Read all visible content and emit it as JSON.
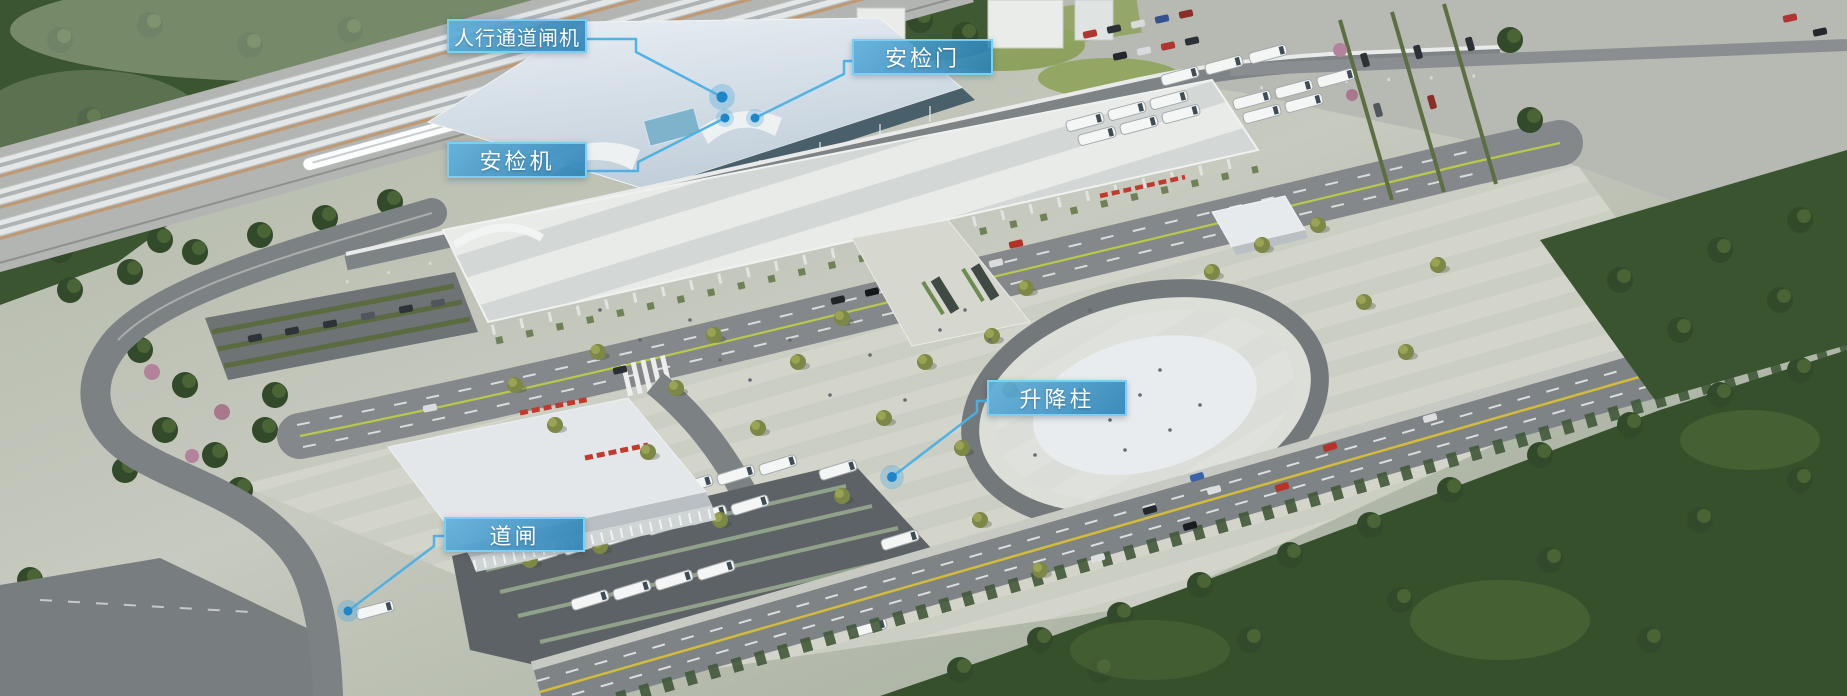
{
  "callouts": [
    {
      "id": "pedestrian-gate",
      "text": "人行通道闸机"
    },
    {
      "id": "security-door",
      "text": "安检门"
    },
    {
      "id": "security-scanner",
      "text": "安检机"
    },
    {
      "id": "lifting-bollard",
      "text": "升降柱"
    },
    {
      "id": "barrier-gate",
      "text": "道闸"
    }
  ],
  "style": {
    "label_bg": "#2e8fc3",
    "label_border": "#7ed1f4",
    "label_text": "#ffffff",
    "leader_line": "#49b0e6",
    "marker_dot": "#1d86c8"
  }
}
